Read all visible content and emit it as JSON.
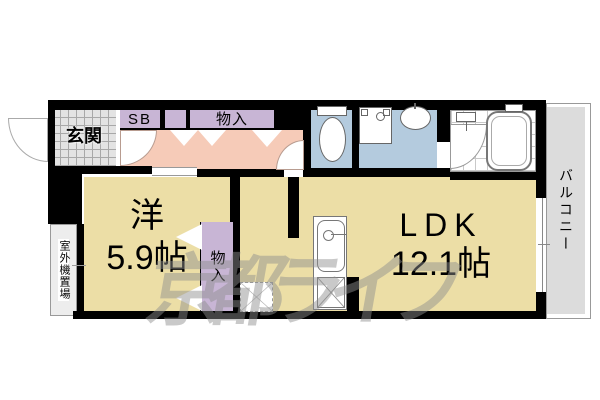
{
  "watermark": {
    "text": "京都ライフ"
  },
  "rooms": {
    "entrance": {
      "label": "玄関"
    },
    "shoe_box": {
      "label": "SB"
    },
    "hallway_storage": {
      "label": "物入"
    },
    "western_room": {
      "type_label": "洋",
      "size_label": "5.9帖"
    },
    "western_room_storage": {
      "label": "物入"
    },
    "ldk": {
      "type_label": "LDK",
      "size_label": "12.1帖"
    },
    "balcony": {
      "label": "バルコニー"
    },
    "outdoor_unit_space": {
      "label": "室外機置場"
    }
  },
  "colors": {
    "wall": "#000000",
    "room-floor": "#ecdea6",
    "hallway-floor": "#f6cbb8",
    "closet": "#c8b5d5",
    "wet-area": "#b4cbde",
    "entrance-tile": "#e3e3e3",
    "balcony-floor": "#dcdcdc",
    "watermark": "#8f8f8f"
  },
  "icons": {
    "toilet": "css-shape",
    "washing-machine-pan": "css-shape",
    "washbasin": "css-shape",
    "bathtub": "css-shape",
    "shower-mixer": "css-shape",
    "kitchen-sink": "css-shape",
    "gas-stove": "css-shape",
    "refrigerator-space": "css-shape",
    "door-swing-arc": "css-shape",
    "bifold-door-mark": "css-shape",
    "sliding-window": "css-shape"
  }
}
